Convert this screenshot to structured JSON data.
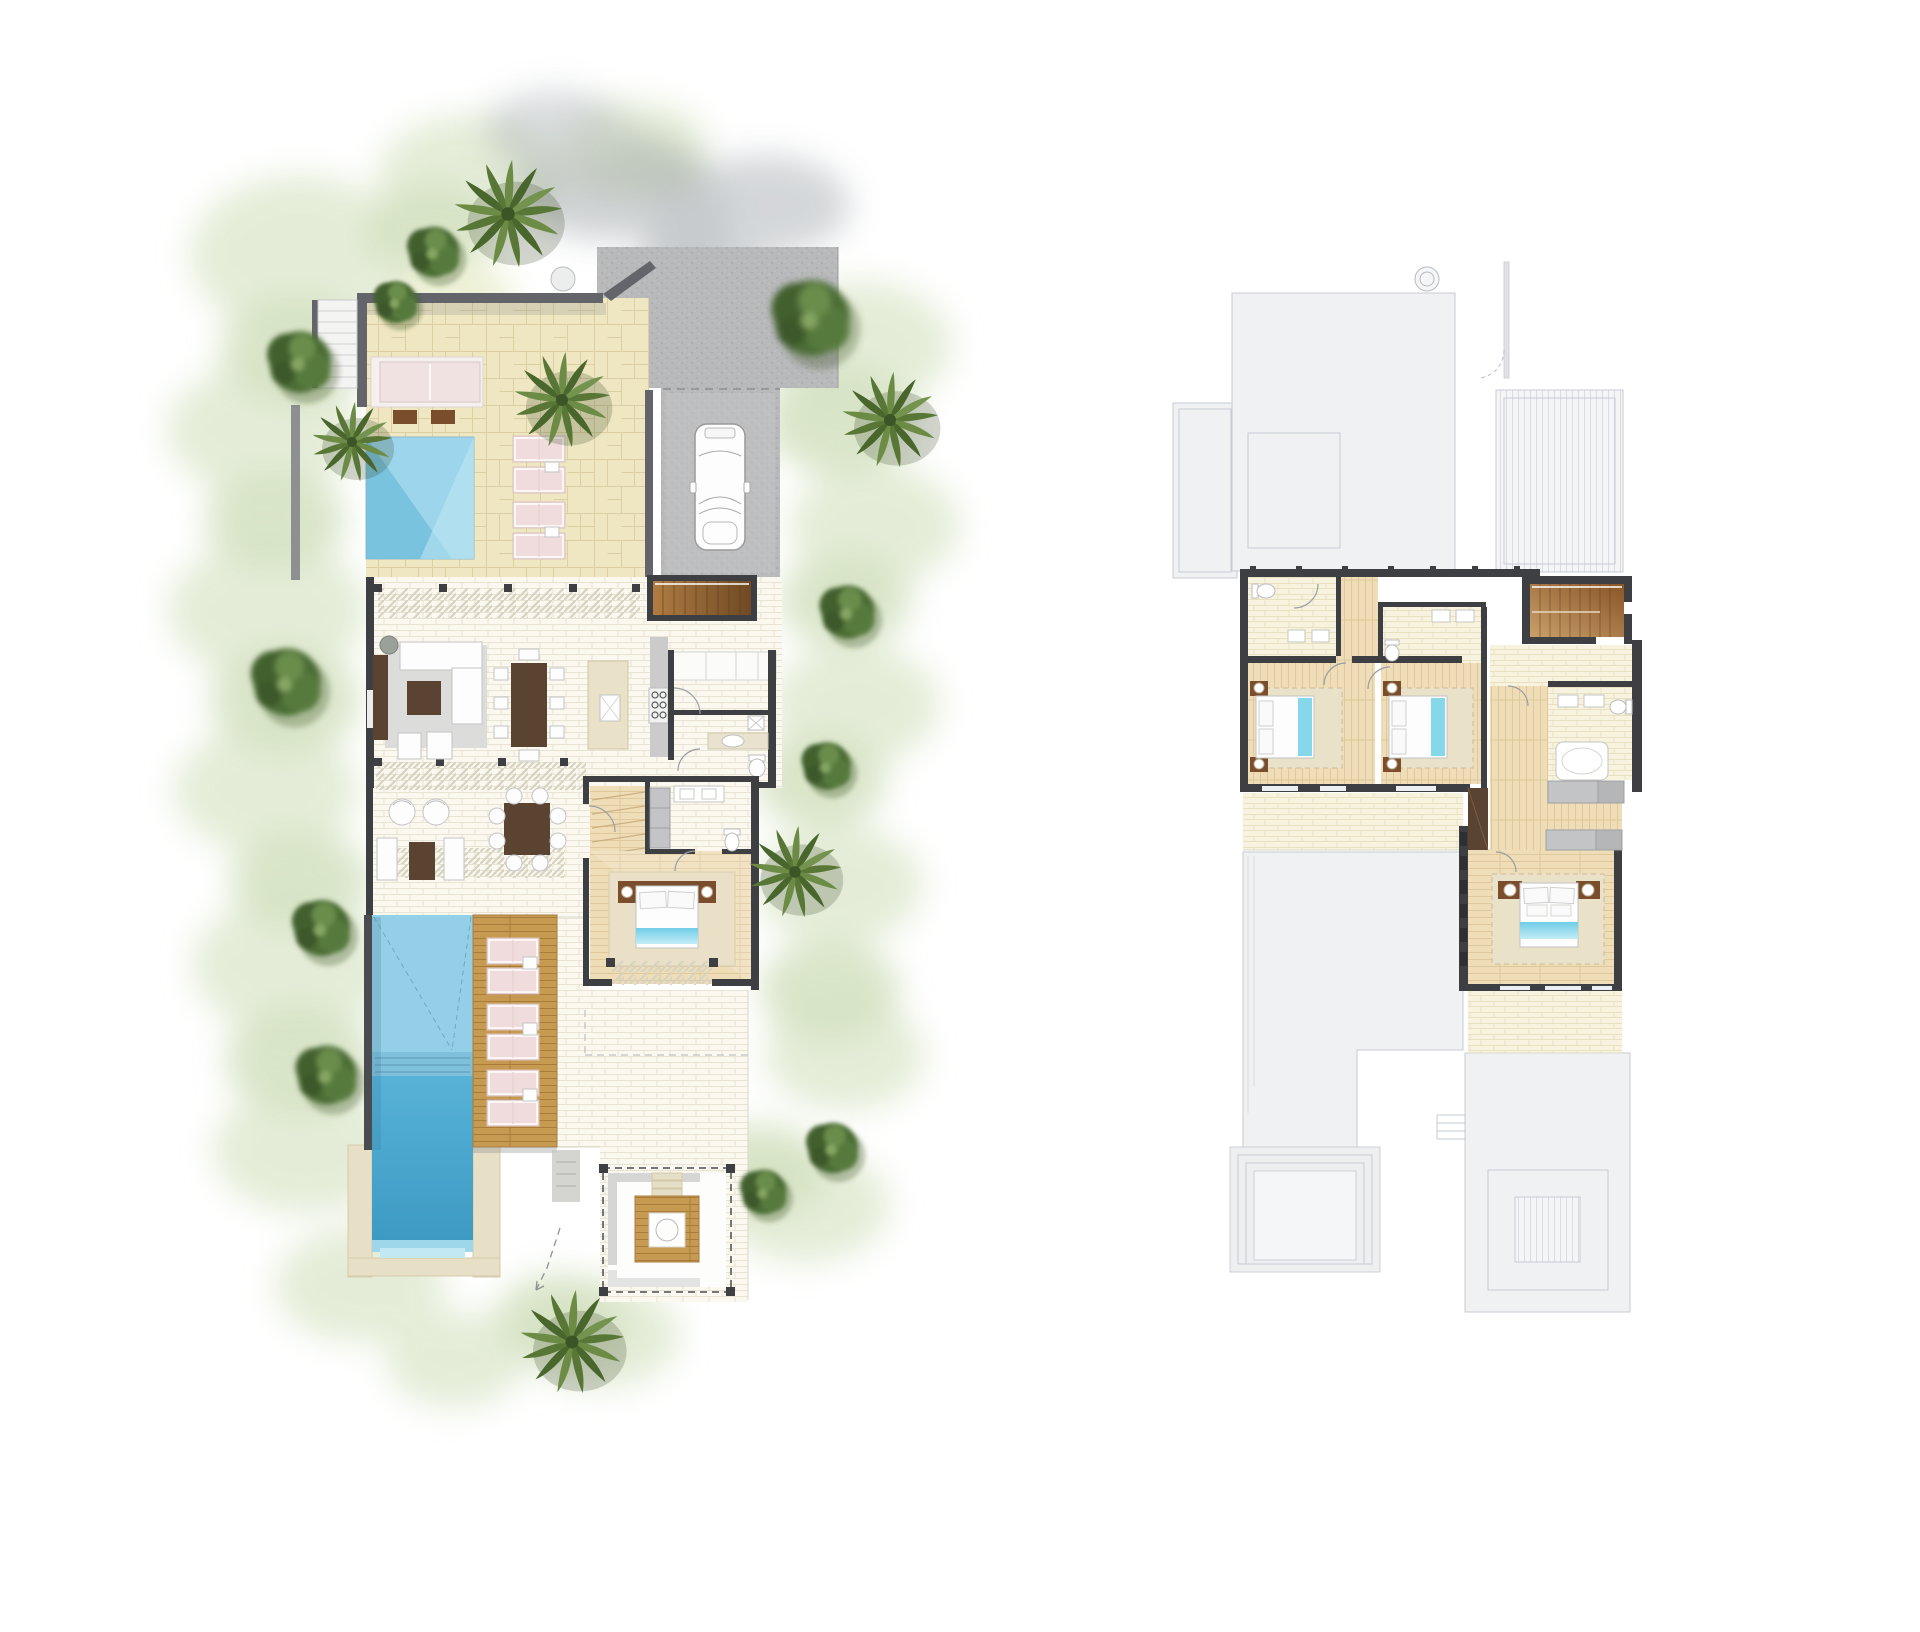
{
  "canvas": {
    "width": 1920,
    "height": 1632,
    "background": "#ffffff"
  },
  "plans": {
    "ground_floor": {
      "label": "ground floor site plan with landscaping",
      "features": {
        "plunge_pool_top": 1,
        "main_lap_pool": 1,
        "sun_loungers_upper_terrace": 4,
        "sun_loungers_pool_deck": 6,
        "parking_spaces": 1,
        "bedrooms": 1,
        "dining_seats": 8,
        "garden_pavilion": 1,
        "palm_trees": 6
      }
    },
    "upper_floor": {
      "label": "upper floor plan with roof outlines",
      "features": {
        "bedrooms": 3,
        "bathrooms": 3,
        "staircases": 1,
        "walk_in_wardrobes": 2,
        "roof_decks_outlined": 3
      }
    }
  },
  "palette": {
    "wall_dark": "#3d3f43",
    "wall_medium": "#63656a",
    "patio_tan": "#efe7c2",
    "tile_white": "#faf8ef",
    "tile_cream": "#f7f3de",
    "wood_floor": "#eeddb7",
    "deck_timber": "#c79a52",
    "pool_shallow": "#9dd6ec",
    "pool_deep": "#3d9ac2",
    "lounger_pink": "#f0dcdc",
    "roof_gray": "#eff1f3",
    "driveway_gray": "#b8b9bb",
    "furniture_brown": "#5a4331",
    "bed_throw_blue": "#86d7ea",
    "vegetation_dark": "#4c6d36",
    "vegetation_light": "#cfe0ba"
  }
}
